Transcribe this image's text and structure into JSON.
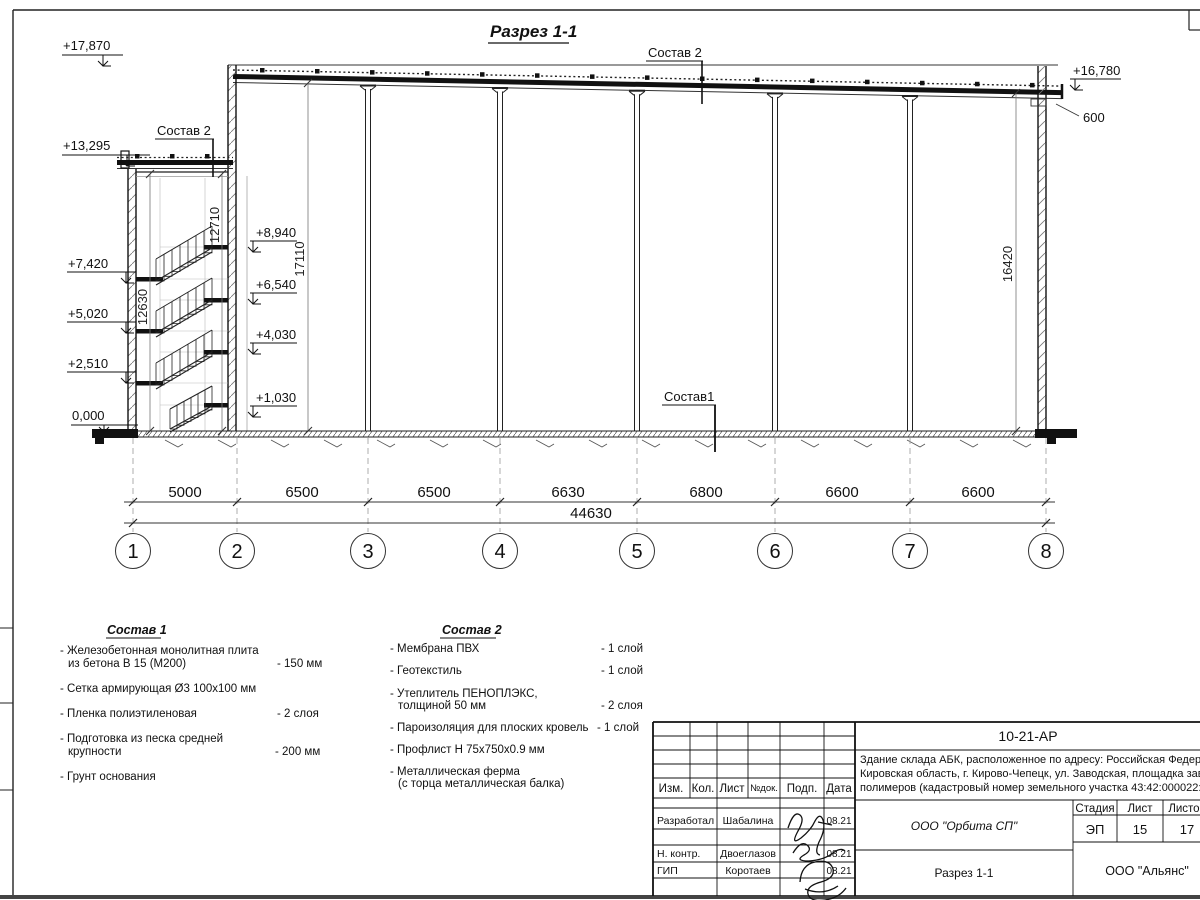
{
  "title": "Разрез 1-1",
  "section": {
    "sostav2_top": "Состав 2",
    "sostav2_left": "Состав 2",
    "sostav1_floor": "Состав1",
    "parapet_dim": "600",
    "elev": {
      "e17870": "+17,870",
      "e13295": "+13,295",
      "e7420": "+7,420",
      "e5020": "+5,020",
      "e2510": "+2,510",
      "e0": "0,000",
      "e8940": "+8,940",
      "e6540": "+6,540",
      "e4030": "+4,030",
      "e1030": "+1,030",
      "e16780": "+16,780"
    },
    "vdims": {
      "d12710": "12710",
      "d12630": "12630",
      "d17110": "17110",
      "d16420": "16420"
    },
    "axes": [
      "1",
      "2",
      "3",
      "4",
      "5",
      "6",
      "7",
      "8"
    ],
    "spans": [
      "5000",
      "6500",
      "6500",
      "6630",
      "6800",
      "6600",
      "6600"
    ],
    "total": "44630"
  },
  "sostav1": {
    "header": "Состав 1",
    "i1a": "- Железобетонная  монолитная плита",
    "i1b": "из бетона В 15 (М200)",
    "i1v": "- 150 мм",
    "i2": "- Сетка армирующая Ø3 100x100 мм",
    "i3": "- Пленка полиэтиленовая",
    "i3v": "-  2 слоя",
    "i4a": "- Подготовка из песка средней",
    "i4b": "крупности",
    "i4v": "- 200 мм",
    "i5": "- Грунт основания"
  },
  "sostav2": {
    "header": "Состав 2",
    "i1": "- Мембрана ПВХ",
    "i1v": "- 1 слой",
    "i2": "- Геотекстиль",
    "i2v": "- 1 слой",
    "i3a": "- Утеплитель ПЕНОПЛЭКС,",
    "i3b": "толщиной 50 мм",
    "i3v": "- 2 слоя",
    "i4": "- Пароизоляция для плоских кровель",
    "i4v": "- 1 слой",
    "i5": "- Профлист Н 75x750x0.9 мм",
    "i6a": "- Металлическая ферма",
    "i6b": "(с торца металлическая балка)"
  },
  "tb": {
    "code": "10-21-АР",
    "desc1": "Здание склада АБК, расположенное по адресу: Российская Федерация,",
    "desc2": "Кировская область, г. Кирово-Чепецк, ул. Заводская, площадка завода",
    "desc3": "полимеров (кадастровый номер земельного участка 43:42:000022:3",
    "org": "ООО \"Орбита СП\"",
    "h_izm": "Изм.",
    "h_kol": "Кол.",
    "h_list": "Лист",
    "h_ndok": "№док.",
    "h_podp": "Подп.",
    "h_data": "Дата",
    "r1_role": "Разработал",
    "r1_name": "Шабалина",
    "r1_date": "08.21",
    "r2_role": "Н. контр.",
    "r2_name": "Двоеглазов",
    "r2_date": "08.21",
    "r3_role": "ГИП",
    "r3_name": "Коротаев",
    "r3_date": "08.21",
    "stage_h": "Стадия",
    "sheet_h": "Лист",
    "sheets_h": "Листов",
    "stage": "ЭП",
    "sheet": "15",
    "sheets": "17",
    "sheet_title": "Разрез 1-1",
    "firm": "ООО \"Альянс\""
  }
}
